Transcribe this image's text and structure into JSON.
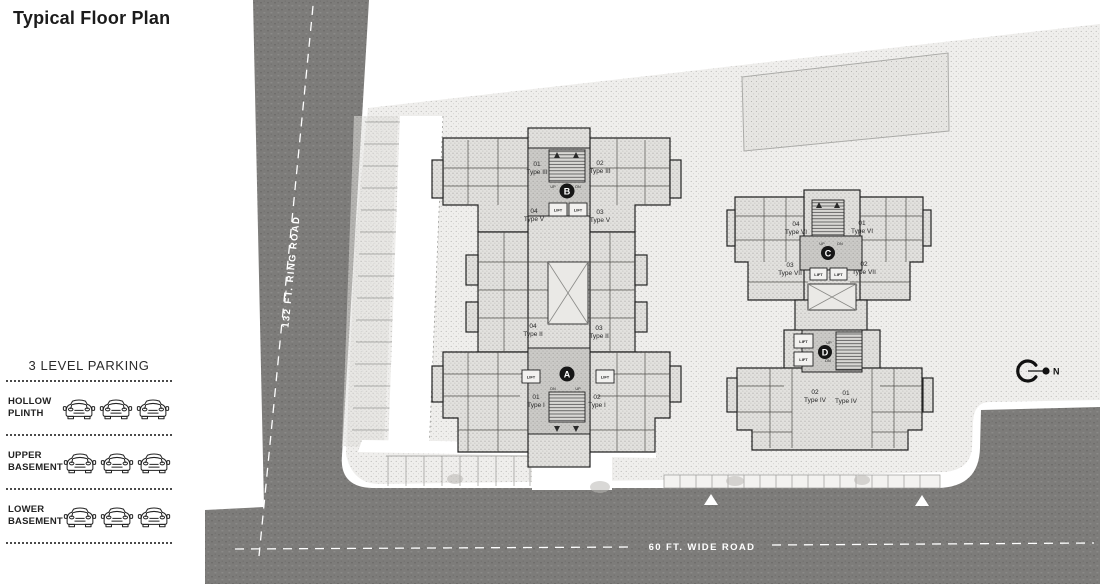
{
  "title": "Typical Floor Plan",
  "parking_legend": {
    "heading": "3 LEVEL PARKING",
    "cars_per_level": 3,
    "levels": [
      {
        "label": "HOLLOW\nPLINTH"
      },
      {
        "label": "UPPER\nBASEMENT"
      },
      {
        "label": "LOWER\nBASEMENT"
      }
    ]
  },
  "roads": {
    "ring_road_label": "132 FT. RING ROAD",
    "wide_road_label": "60 FT. WIDE ROAD"
  },
  "north_label": "N",
  "buildings": {
    "labels": {
      "lift": "LIFT",
      "up": "UP",
      "dn": "DN"
    },
    "left": {
      "cores": [
        {
          "badge": "B"
        },
        {
          "badge": "A"
        }
      ],
      "units": [
        {
          "num": "01",
          "type": "Type III"
        },
        {
          "num": "02",
          "type": "Type III"
        },
        {
          "num": "04",
          "type": "Type V"
        },
        {
          "num": "03",
          "type": "Type V"
        },
        {
          "num": "04",
          "type": "Type II"
        },
        {
          "num": "03",
          "type": "Type II"
        },
        {
          "num": "01",
          "type": "Type I"
        },
        {
          "num": "02",
          "type": "Type I"
        }
      ]
    },
    "right": {
      "cores": [
        {
          "badge": "C"
        },
        {
          "badge": "D"
        }
      ],
      "units": [
        {
          "num": "04",
          "type": "Type VI"
        },
        {
          "num": "01",
          "type": "Type VI"
        },
        {
          "num": "03",
          "type": "Type VII"
        },
        {
          "num": "02",
          "type": "Type VII"
        },
        {
          "num": "02",
          "type": "Type IV"
        },
        {
          "num": "01",
          "type": "Type IV"
        }
      ]
    }
  },
  "colors": {
    "road": "#7d7c7a",
    "site_fill": "#efeeec",
    "building_fill": "#e3e2df",
    "core_fill": "#cfcecb",
    "wall": "#222222",
    "road_text": "#ffffff"
  }
}
